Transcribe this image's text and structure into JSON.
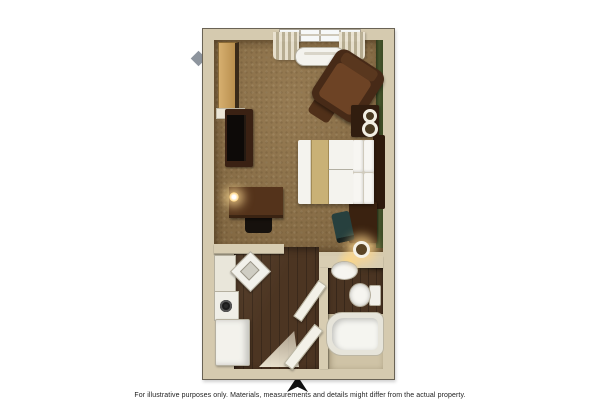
{
  "footer": {
    "disclaimer": "For illustrative purposes only. Materials, measurements and details might differ from the actual property.",
    "entry_arrow_icon": "up-arrow"
  },
  "palette": {
    "background": "#ffffff",
    "wall": "#d5caaf",
    "carpet_brown": "#8b6f46",
    "wood_floor": "#4c3522",
    "accent_wall_green": "#44512a",
    "dark_furniture_wood": "#3a2113",
    "bed_runner_tan": "#c9b176",
    "linens_white": "#f4f3ee",
    "lamp_glow": "#ffd98c"
  },
  "furniture": [
    "closet",
    "window",
    "curtains",
    "ac-unit",
    "armchair",
    "ottoman",
    "side-table",
    "table-lamps",
    "tv-stand",
    "television",
    "desk",
    "desk-lamp",
    "desk-chair",
    "bed",
    "headboard",
    "pillows",
    "nightstand",
    "floor-lamp",
    "side-chair",
    "room-divider-wall",
    "kitchen-counter",
    "kitchen-sink",
    "cooktop",
    "refrigerator",
    "vanity-light",
    "bathroom-sink",
    "toilet",
    "bathtub",
    "bathroom-door",
    "entry-door"
  ]
}
